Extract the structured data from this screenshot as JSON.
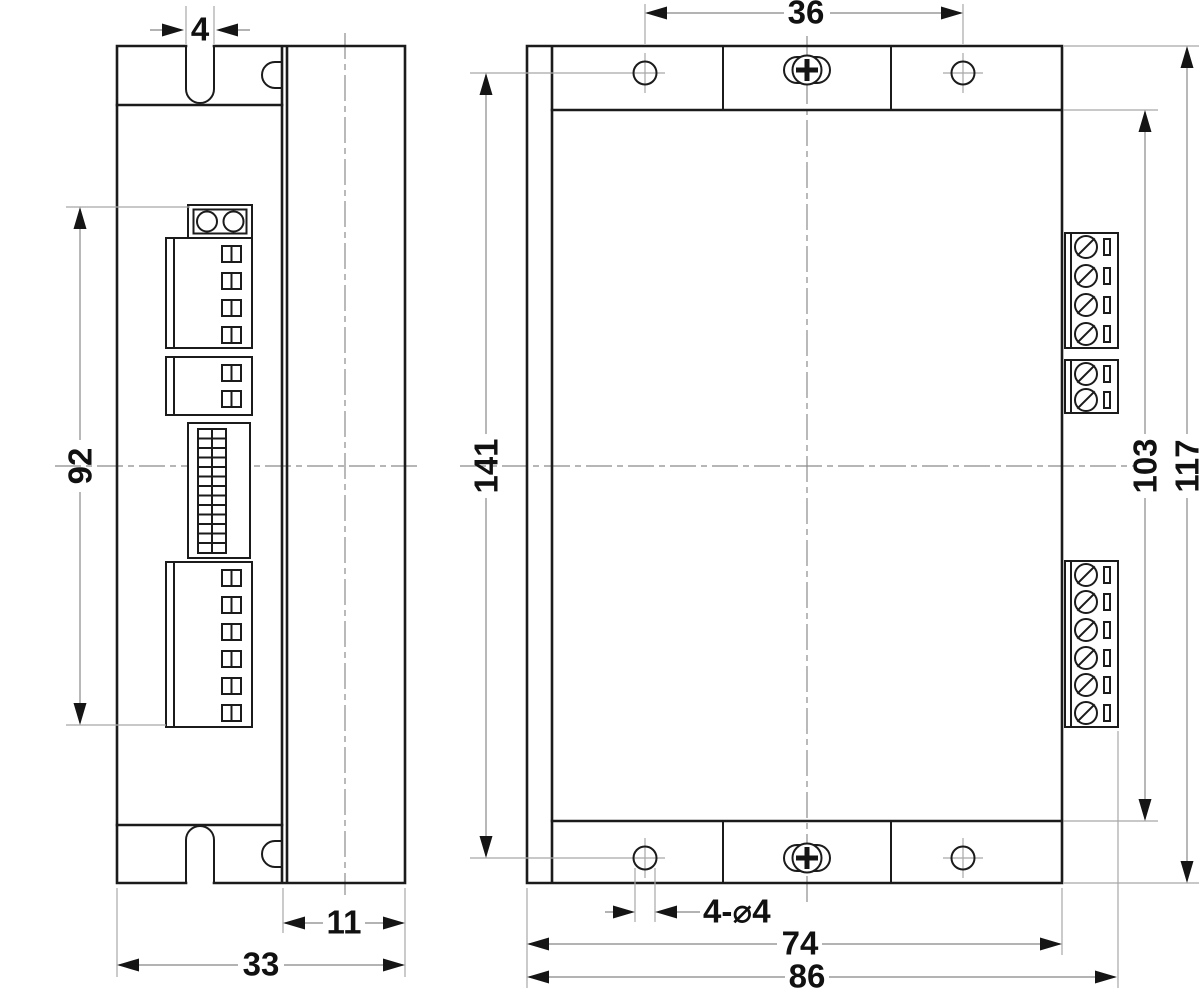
{
  "drawing": {
    "type": "mechanical-outline-drawing",
    "units": "mm",
    "side_view": {
      "dimensions": {
        "slot_width": "4",
        "connector_region_height": "92",
        "body_depth": "11",
        "overall_depth": "33"
      },
      "features": {
        "top_slot": "U-notch in mounting flange",
        "bottom_slot": "U-notch in mounting flange",
        "connector_blocks": [
          "2-pin socket",
          "4-position terminal",
          "2-position terminal",
          "dip-switch bank",
          "6-position terminal"
        ]
      }
    },
    "front_view": {
      "dimensions": {
        "top_hole_spacing": "36",
        "vertical_hole_span": "141",
        "flange_inner_height": "103",
        "flange_outer_height": "117",
        "hole_callout": "4-⌀4",
        "flange_width": "74",
        "overall_width": "86"
      },
      "features": {
        "mounting_holes": 4,
        "center_screws": 2,
        "right_terminals": [
          "4-screw terminal",
          "2-screw terminal",
          "6-screw terminal"
        ]
      }
    }
  }
}
